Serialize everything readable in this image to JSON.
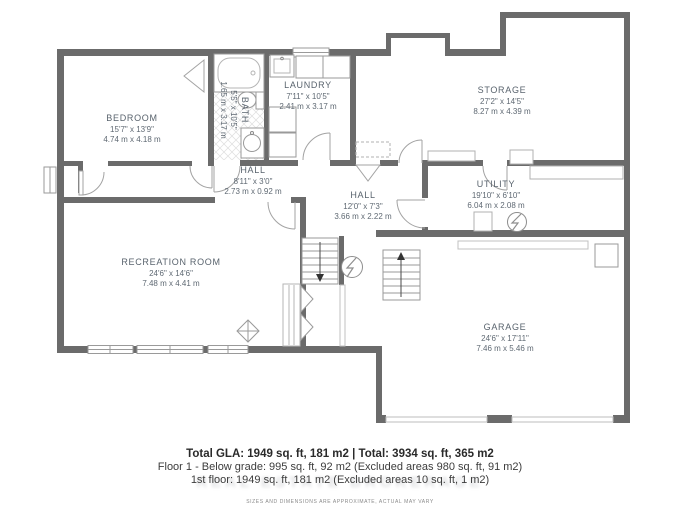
{
  "floor_plan": {
    "rooms": [
      {
        "name": "BEDROOM",
        "imperial": "15'7\" x 13'9\"",
        "metric": "4.74 m x 4.18 m"
      },
      {
        "name": "BATH",
        "imperial": "5'5\" x 10'5\"",
        "metric": "1.65 m x 3.17 m"
      },
      {
        "name": "LAUNDRY",
        "imperial": "7'11\" x 10'5\"",
        "metric": "2.41 m x 3.17 m"
      },
      {
        "name": "STORAGE",
        "imperial": "27'2\" x 14'5\"",
        "metric": "8.27 m x 4.39 m"
      },
      {
        "name": "HALL",
        "imperial": "8'11\" x 3'0\"",
        "metric": "2.73 m x 0.92 m"
      },
      {
        "name": "HALL",
        "imperial": "12'0\" x 7'3\"",
        "metric": "3.66 m x 2.22 m"
      },
      {
        "name": "UTILITY",
        "imperial": "19'10\" x 6'10\"",
        "metric": "6.04 m x 2.08 m"
      },
      {
        "name": "RECREATION ROOM",
        "imperial": "24'6\" x 14'6\"",
        "metric": "7.48 m x 4.41 m"
      },
      {
        "name": "GARAGE",
        "imperial": "24'6\" x 17'11\"",
        "metric": "7.46 m x 5.46 m"
      }
    ],
    "colors": {
      "wall": "#6b6b6b",
      "fixture_line": "#9a9a9a",
      "label_text": "#5c6670"
    }
  },
  "footer": {
    "total_line": "Total GLA: 1949 sq. ft, 181 m2 | Total: 3934 sq. ft, 365 m2",
    "floor_line_1": "Floor 1 - Below grade: 995 sq. ft, 92 m2 (Excluded areas 980 sq. ft, 91 m2)",
    "floor_line_2": "1st floor: 1949 sq. ft, 181 m2 (Excluded areas 10 sq. ft, 1 m2)",
    "watermark": "REAL ESTATE BROKERAGE",
    "disclaimer": "SIZES AND DIMENSIONS ARE APPROXIMATE, ACTUAL MAY VARY"
  }
}
